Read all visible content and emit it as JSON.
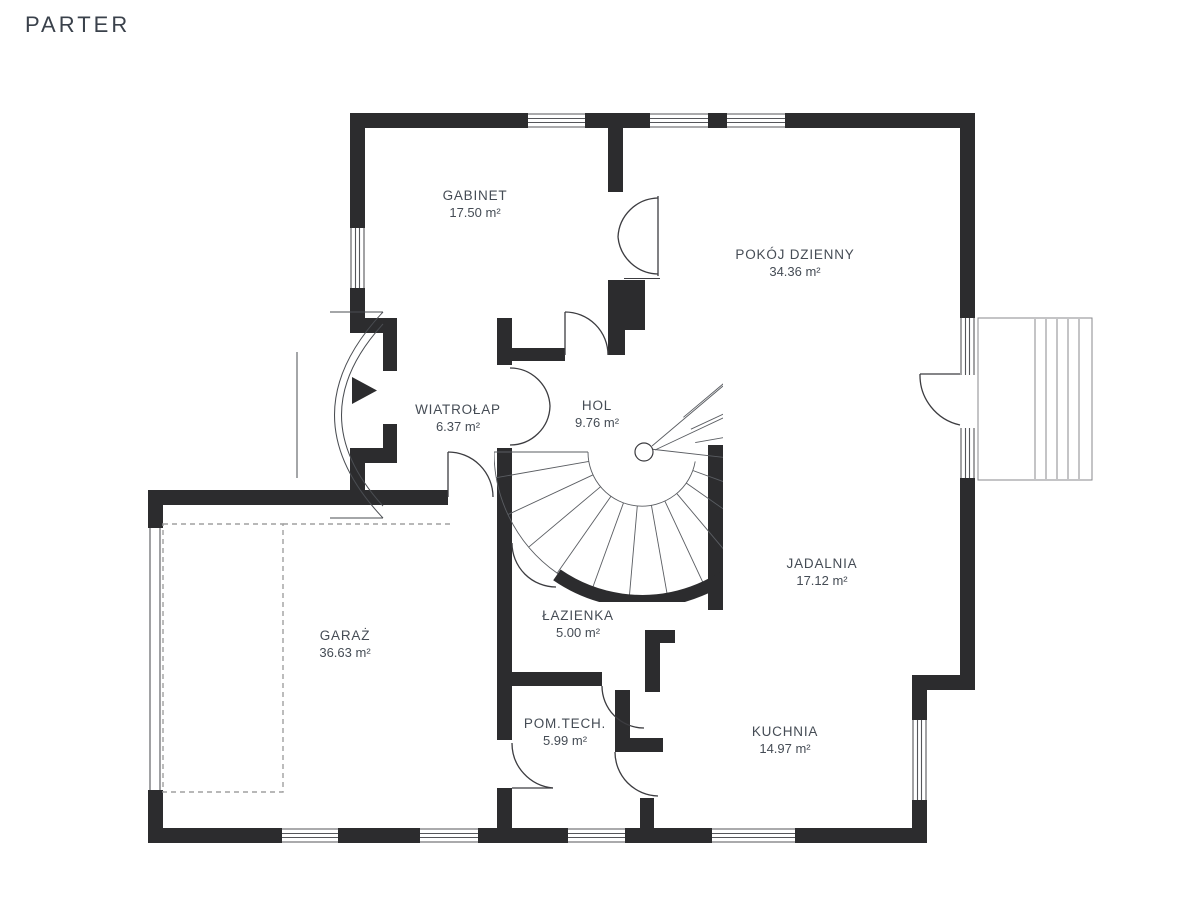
{
  "title": "PARTER",
  "colors": {
    "wall": "#2c2c2e",
    "door_line": "#3c3c40",
    "window_line": "#55565a",
    "stair_line": "#5a5d62",
    "dashed_outline": "#a0a0a0",
    "text": "#454c55"
  },
  "rooms": [
    {
      "name": "GABINET",
      "area": "17.50 m²"
    },
    {
      "name": "POKÓJ DZIENNY",
      "area": "34.36 m²"
    },
    {
      "name": "WIATROŁAP",
      "area": "6.37 m²"
    },
    {
      "name": "HOL",
      "area": "9.76 m²"
    },
    {
      "name": "JADALNIA",
      "area": "17.12 m²"
    },
    {
      "name": "GARAŻ",
      "area": "36.63 m²"
    },
    {
      "name": "ŁAZIENKA",
      "area": "5.00 m²"
    },
    {
      "name": "POM.TECH.",
      "area": "5.99 m²"
    },
    {
      "name": "KUCHNIA",
      "area": "14.97 m²"
    }
  ]
}
